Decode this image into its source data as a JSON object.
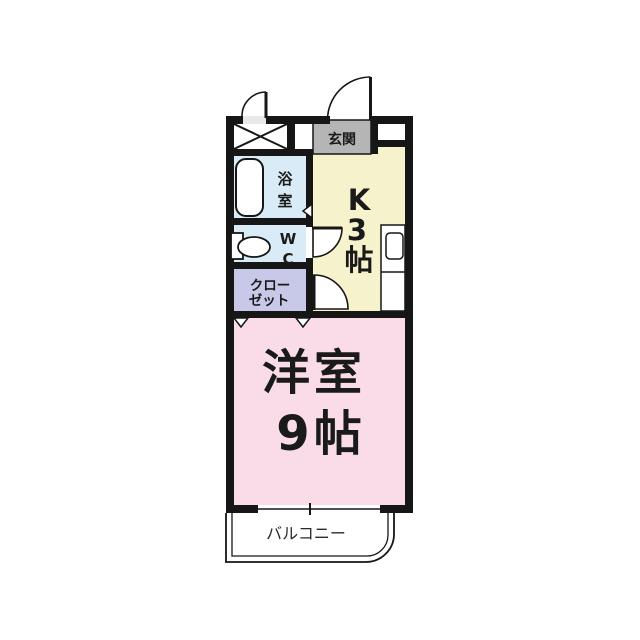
{
  "colors": {
    "wall": "#161616",
    "bathroom_blue": "#d8ebf6",
    "closet_lavender": "#c8c8e9",
    "kitchen_yellow": "#f6f2cb",
    "room_pink": "#fadce8",
    "genkan_gray": "#b5b5b5",
    "fixture_white": "#ffffff",
    "door_sill_gray": "#e8e8e8"
  },
  "rooms": {
    "genkan": {
      "label": "玄関"
    },
    "kitchen": {
      "label": "K3帖",
      "chars": [
        "K",
        "3",
        "帖"
      ]
    },
    "bathroom": {
      "label": "浴室",
      "chars": [
        "浴",
        "室"
      ]
    },
    "wc": {
      "label": "WC",
      "chars": [
        "W",
        "C"
      ]
    },
    "closet": {
      "label": "クローゼット",
      "lines": [
        "クロー",
        "ゼット"
      ]
    },
    "western_room": {
      "label": "洋室9帖",
      "lines": [
        "洋室",
        "9帖"
      ]
    },
    "balcony": {
      "label": "バルコニー"
    }
  },
  "fixtures": {
    "bathtub": "浴槽",
    "toilet": "便器",
    "kitchen_counter": "キッチン",
    "pipe_space": "PS"
  }
}
